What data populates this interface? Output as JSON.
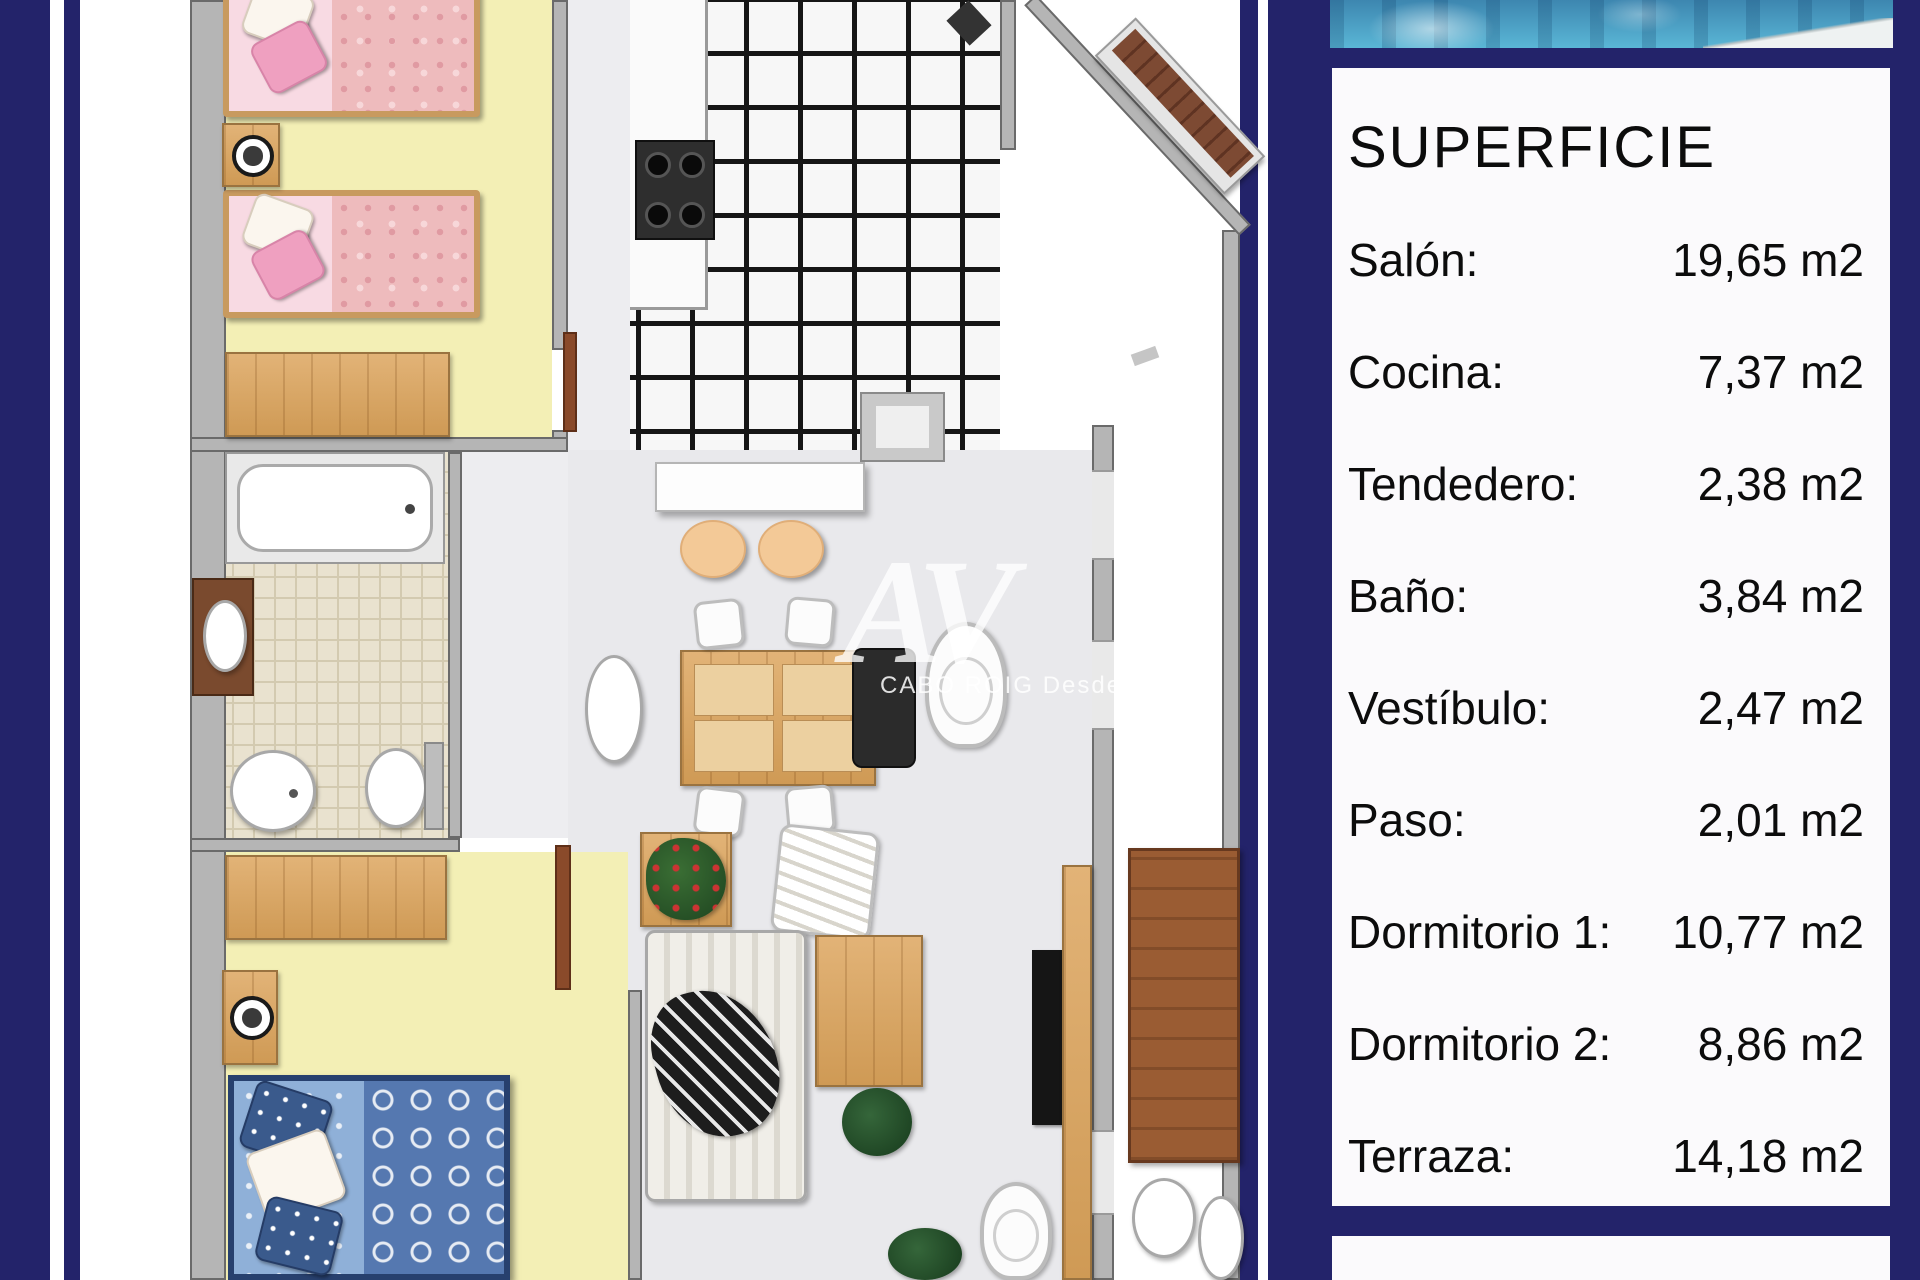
{
  "panel": {
    "title": "SUPERFICIE",
    "rows": [
      {
        "label": "Salón:",
        "value": "19,65 m2"
      },
      {
        "label": "Cocina:",
        "value": "7,37 m2"
      },
      {
        "label": "Tendedero:",
        "value": "2,38 m2"
      },
      {
        "label": "Baño:",
        "value": "3,84 m2"
      },
      {
        "label": "Vestíbulo:",
        "value": "2,47 m2"
      },
      {
        "label": "Paso:",
        "value": "2,01 m2"
      },
      {
        "label": "Dormitorio 1:",
        "value": "10,77 m2"
      },
      {
        "label": "Dormitorio 2:",
        "value": "8,86 m2"
      },
      {
        "label": "Terraza:",
        "value": "14,18 m2"
      }
    ]
  },
  "watermark": {
    "logo": "AV",
    "caption": "CABO ROIG  Desde 1970"
  },
  "floor_plan": {
    "rooms": [
      "Dormitorio 1",
      "Baño",
      "Dormitorio 2",
      "Cocina",
      "Tendedero",
      "Vestíbulo",
      "Paso",
      "Salón",
      "Terraza"
    ],
    "colors": {
      "bedroom_floor": "#f3efb5",
      "bath_tile": "#e9e2cf",
      "salon_floor": "#e9e9ec",
      "kitchen_grid_line": "#161616",
      "wood": "#d9a463",
      "pink_bed": "#eebbbd",
      "blue_bed": "#5578b0",
      "wall": "#b5b5b5"
    }
  },
  "frame_color": "#23236a",
  "pool_color": "#4fa3c4"
}
